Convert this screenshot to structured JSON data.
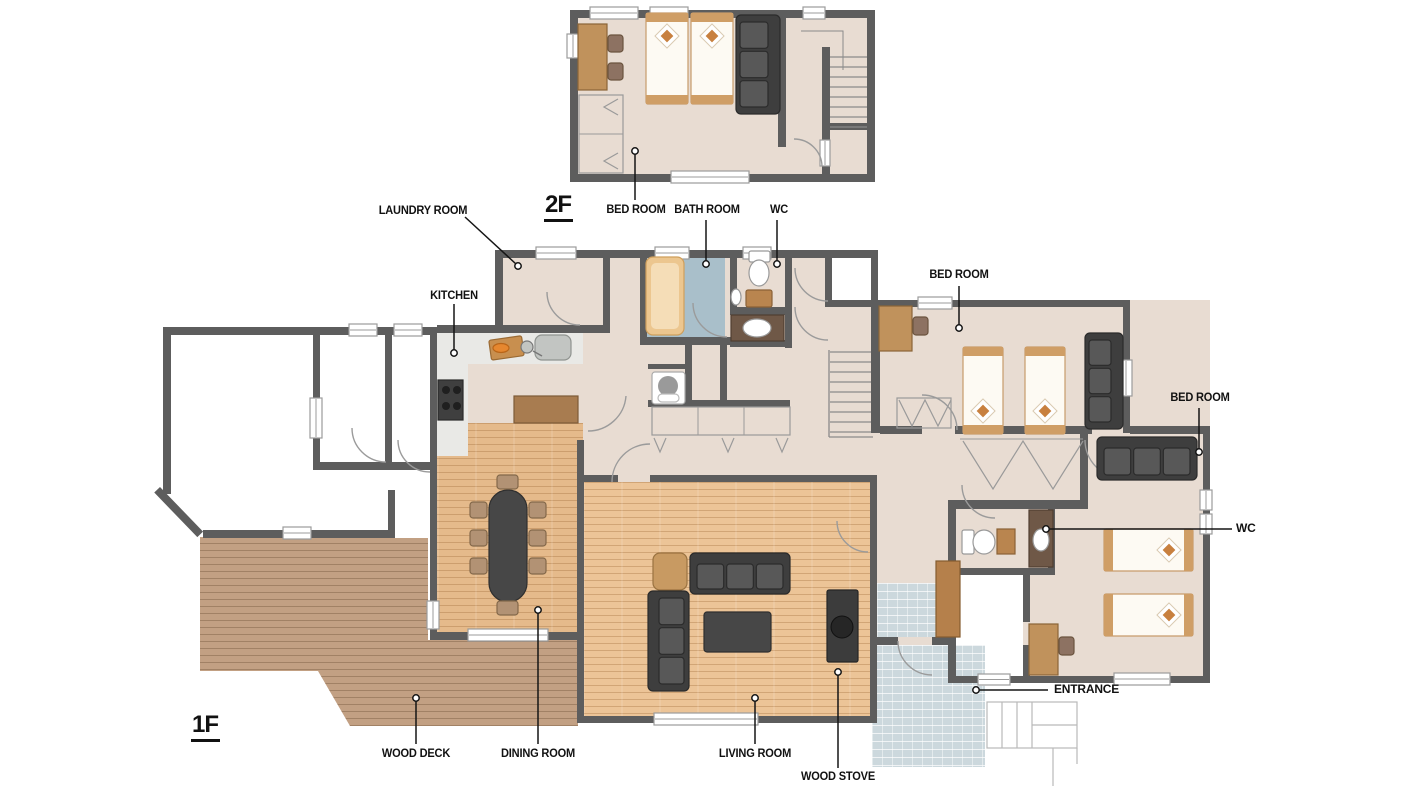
{
  "floors": [
    {
      "id": "2f",
      "label": "2F"
    },
    {
      "id": "1f",
      "label": "1F"
    }
  ],
  "labels": {
    "laundry_room": "LAUNDRY ROOM",
    "kitchen": "KITCHEN",
    "bedroom_2f": "BED ROOM",
    "bath_room": "BATH ROOM",
    "wc_north": "WC",
    "bedroom_north": "BED ROOM",
    "bedroom_east": "BED ROOM",
    "wc_east": "WC",
    "entrance": "ENTRANCE",
    "wood_deck": "WOOD DECK",
    "dining_room": "DINING ROOM",
    "living_room": "LIVING ROOM",
    "wood_stove": "WOOD STOVE"
  },
  "colors": {
    "wall": "#5d5d5d",
    "floor": "#e8dcd2",
    "floor_white": "#ffffff",
    "wood_dining": "#e5ba8b",
    "wood_living": "#ecc497",
    "deck": "#c2a083",
    "kitchen_floor": "#e9e9e6",
    "bath_floor": "#a9bfca",
    "tile": "#ccd8dd",
    "sofa_dark": "#3e3e3e",
    "sofa_cushion": "#585858",
    "table_dark": "#474747",
    "furniture_wood": "#c0925c",
    "furniture_wood_dark": "#a87c50",
    "counter_dark_brown": "#6f5847",
    "bed_frame": "#cf9e66",
    "bed_sheet": "#fdfaf3",
    "pillow_accent": "#c8803f",
    "chair_tan": "#b29274",
    "label_text": "#111111",
    "line_gray": "#9b9b9b",
    "window_white": "#ffffff"
  }
}
